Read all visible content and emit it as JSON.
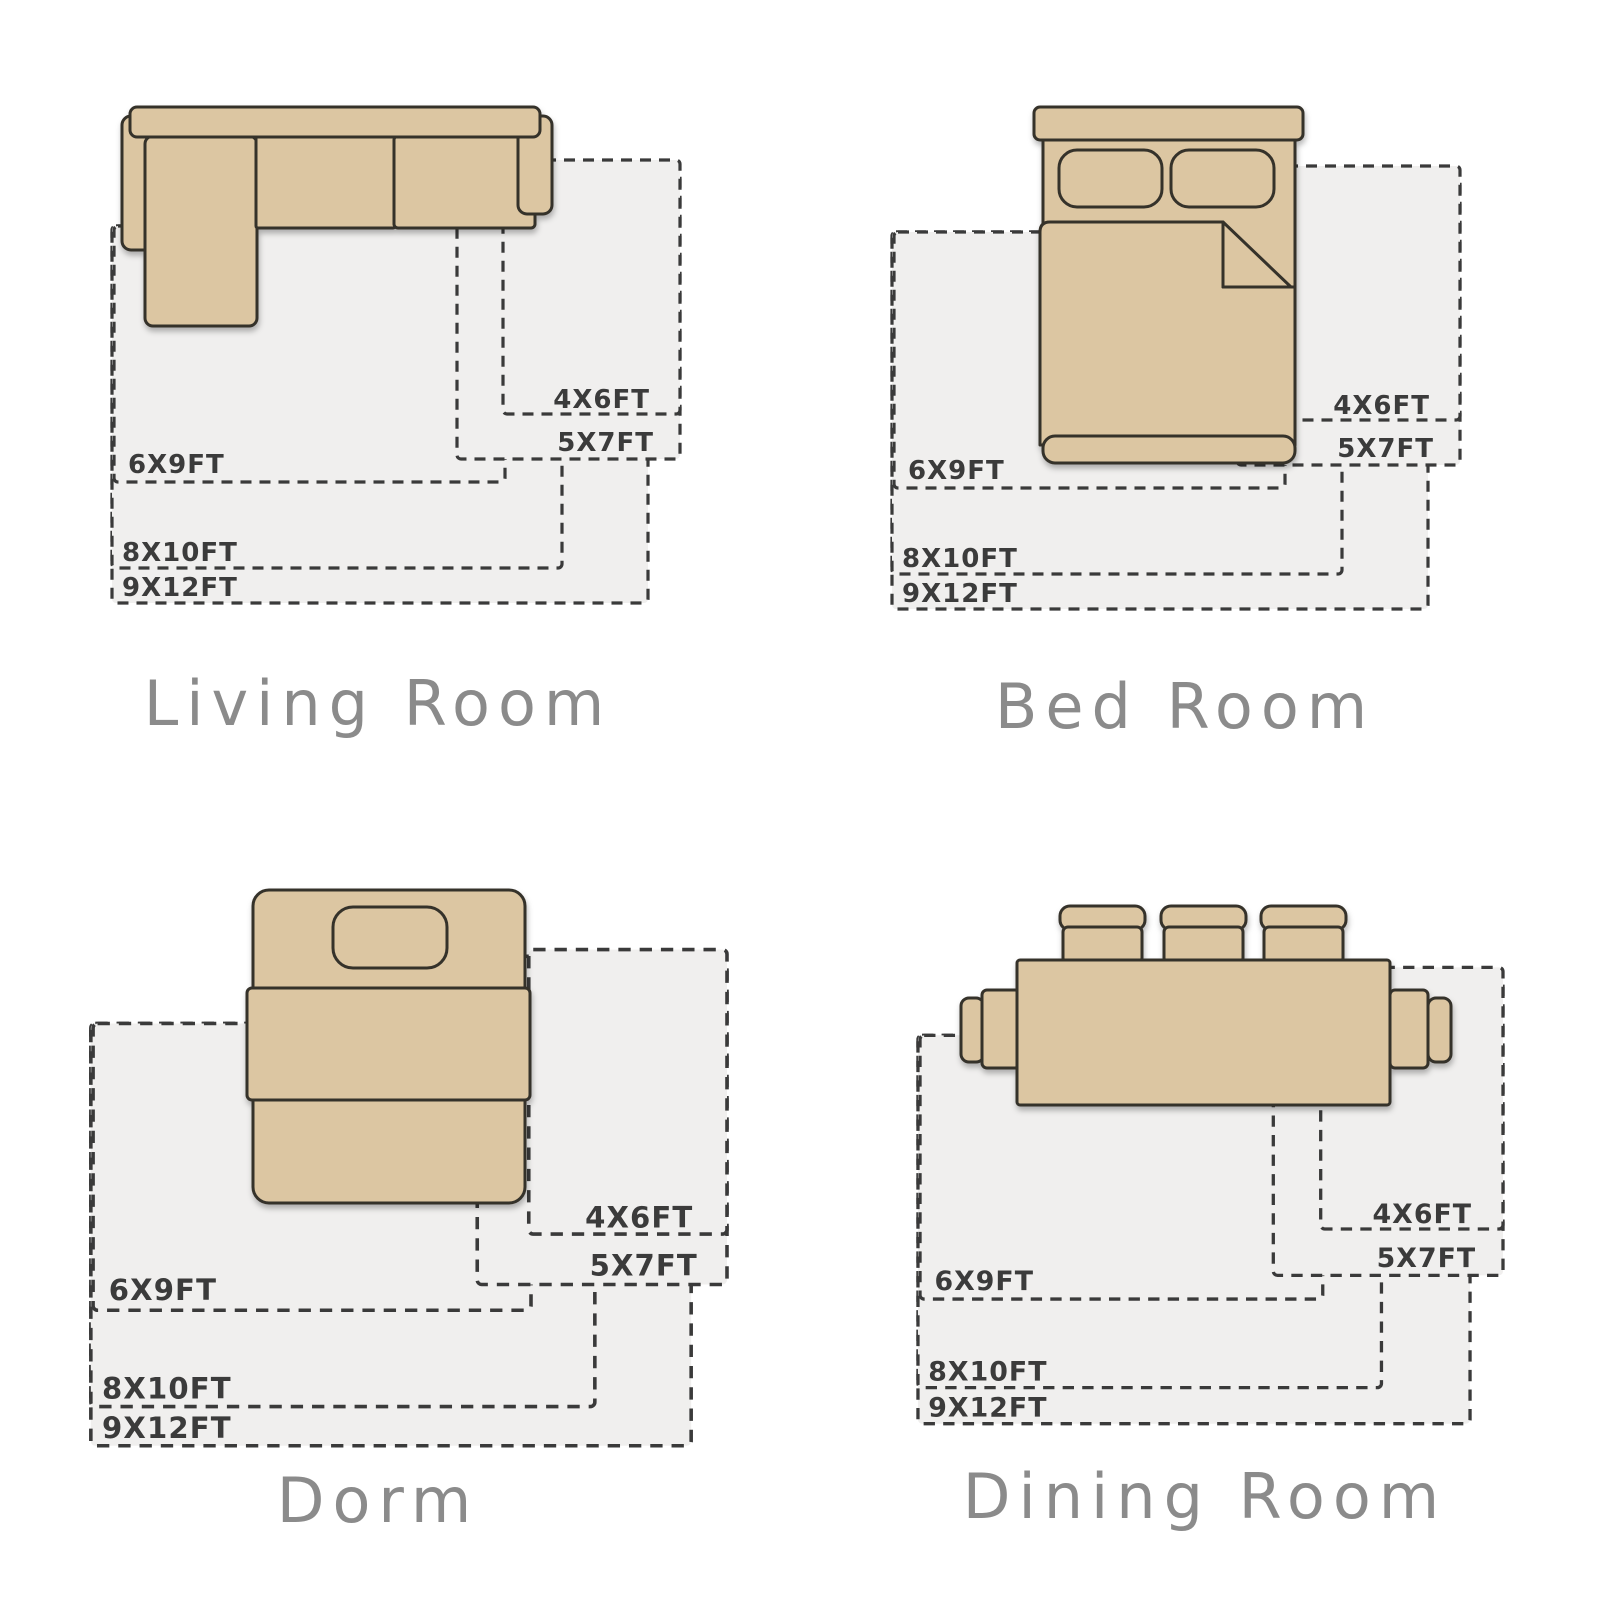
{
  "page": {
    "background": "#ffffff",
    "description_icon": "rug-size-guide-diagram"
  },
  "colors": {
    "furniture_fill": "#dcc6a2",
    "furniture_outline": "#35302a",
    "rug_fill": "#f0efee",
    "rug_dash": "#3a3a3a",
    "size_label_text": "#3b3b3b",
    "room_title_text": "#8b8b8b"
  },
  "rug_sizes": [
    "4X6FT",
    "5X7FT",
    "6X9FT",
    "8X10FT",
    "9X12FT"
  ],
  "sections": [
    {
      "title": "Living Room",
      "furniture_icon": "sectional-sofa-icon"
    },
    {
      "title": "Bed Room",
      "furniture_icon": "double-bed-icon"
    },
    {
      "title": "Dorm",
      "furniture_icon": "twin-bed-icon"
    },
    {
      "title": "Dining Room",
      "furniture_icon": "dining-table-icon"
    }
  ]
}
